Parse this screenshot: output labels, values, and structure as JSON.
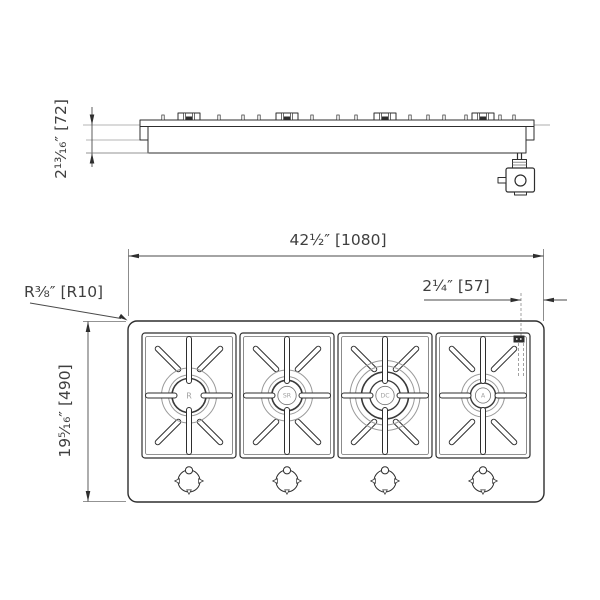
{
  "drawing": {
    "side_view": {
      "height_dim": "2¹³⁄₁₆″ [72]"
    },
    "plan_view": {
      "width_dim": "42½″ [1080]",
      "offset_dim": "2¼″ [57]",
      "corner_radius_dim": "R⅜″ [R10]",
      "depth_dim": "19⁵⁄₁₆″ [490]",
      "burners": [
        {
          "label": "R"
        },
        {
          "label": "SR"
        },
        {
          "label": "DC"
        },
        {
          "label": "A"
        }
      ]
    },
    "icons": {
      "igniter_mark": "black-rectangle",
      "gas_valve": "box-with-circle"
    },
    "colors": {
      "line": "#2e2e2e",
      "light_line": "#9a9a9a",
      "counter_line": "#b5b5b5",
      "background": "#ffffff"
    }
  }
}
